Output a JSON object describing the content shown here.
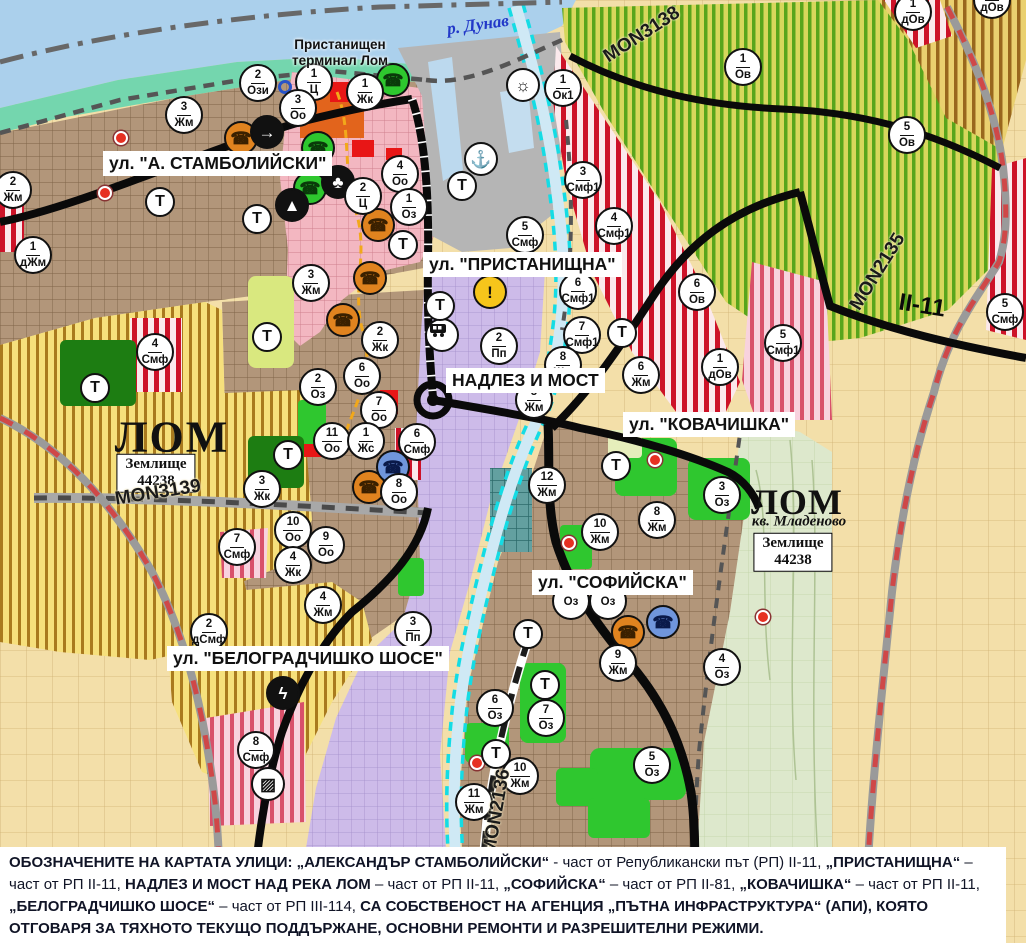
{
  "colors": {
    "water": "#abd0ec",
    "shore": "#74d6ae",
    "urban_brown": "#b2967a",
    "industrial_purple": "#cdbbe9",
    "vineyard_yellow": "#f6e07c",
    "orchard_green": "#d7d75c",
    "smf_pink": "#f3b7c1",
    "zone_red_stripe": "#cd1228",
    "road_black": "#0a0a0a",
    "railway_red": "#cf4848",
    "channel_cyan": "#14dce4",
    "park_green": "#2fc72f",
    "legend_text": "#101426"
  },
  "labels": [
    {
      "t": "ул. \"А. СТАМБОЛИЙСКИ\"",
      "name": "street-label-stamboliyski",
      "cls": "street",
      "x": 103,
      "y": 151
    },
    {
      "t": "ул. \"ПРИСТАНИЩНА\"",
      "name": "street-label-pristanishtna",
      "cls": "street",
      "x": 423,
      "y": 252
    },
    {
      "t": "НАДЛЕЗ И МОСТ",
      "name": "street-label-nadlez-i-most",
      "cls": "street",
      "x": 446,
      "y": 368
    },
    {
      "t": "ул. \"КОВАЧИШКА\"",
      "name": "street-label-kovachishka",
      "cls": "street",
      "x": 623,
      "y": 412
    },
    {
      "t": "ул. \"СОФИЙСКА\"",
      "name": "street-label-sofiyska",
      "cls": "street",
      "x": 532,
      "y": 570
    },
    {
      "t": "ул. \"БЕЛОГРАДЧИШКО ШОСЕ\"",
      "name": "street-label-belogradchishko-shose",
      "cls": "street",
      "x": 167,
      "y": 646
    },
    {
      "t": "р. Дунав",
      "name": "river-danube-label",
      "cls": "river",
      "x": 478,
      "y": 25,
      "c": 1,
      "rot": -8
    },
    {
      "t": "Пристанищен\nтерминал Лом",
      "name": "port-terminal-label",
      "cls": "place",
      "x": 340,
      "y": 53,
      "c": 1
    },
    {
      "t": "ЛОМ",
      "name": "city-label-lom",
      "cls": "city",
      "x": 172,
      "y": 437,
      "c": 1
    },
    {
      "t": "Землище\n44238",
      "name": "land-unit-44238-label",
      "cls": "zbox",
      "x": 156,
      "y": 473,
      "c": 1
    },
    {
      "t": "MON3139",
      "name": "road-label-mon3139",
      "cls": "road",
      "x": 158,
      "y": 493,
      "c": 1,
      "rot": -9
    },
    {
      "t": "ЛОМ",
      "name": "city-label-lom-mladenovo",
      "cls": "city2",
      "x": 797,
      "y": 502,
      "c": 1
    },
    {
      "t": "кв. Младеново",
      "name": "quarter-label-mladenovo",
      "cls": "quarter",
      "x": 799,
      "y": 522,
      "c": 1
    },
    {
      "t": "Землище\n44238",
      "name": "land-unit-44238-label-2",
      "cls": "zbox",
      "x": 793,
      "y": 552,
      "c": 1
    },
    {
      "t": "MON2135",
      "name": "road-label-mon2135",
      "cls": "road",
      "x": 878,
      "y": 272,
      "c": 1,
      "rot": -58
    },
    {
      "t": "MON3138",
      "name": "road-label-mon3138",
      "cls": "road",
      "x": 642,
      "y": 35,
      "c": 1,
      "rot": -33
    },
    {
      "t": "MON2136",
      "name": "road-label-mon2136",
      "cls": "road",
      "x": 497,
      "y": 812,
      "c": 1,
      "rot": -80
    },
    {
      "t": "II-11",
      "name": "road-label-ii-11",
      "cls": "roadbig",
      "x": 922,
      "y": 306,
      "c": 1,
      "rot": 9
    }
  ],
  "markers": [
    {
      "n": "2",
      "c": "Ози",
      "x": 258,
      "y": 83
    },
    {
      "n": "1",
      "c": "Ц",
      "x": 314,
      "y": 82
    },
    {
      "n": "1",
      "c": "Жк",
      "x": 365,
      "y": 92
    },
    {
      "n": "3",
      "c": "Оо",
      "x": 298,
      "y": 108
    },
    {
      "n": "3",
      "c": "Жм",
      "x": 184,
      "y": 115
    },
    {
      "n": "2",
      "c": "Жм",
      "x": 13,
      "y": 190
    },
    {
      "n": "1",
      "c": "дЖм",
      "x": 33,
      "y": 255
    },
    {
      "n": "1",
      "c": "Ок1",
      "x": 563,
      "y": 88
    },
    {
      "n": "4",
      "c": "Оо",
      "x": 400,
      "y": 174
    },
    {
      "n": "2",
      "c": "Ц",
      "x": 363,
      "y": 196
    },
    {
      "n": "1",
      "c": "Оз",
      "x": 409,
      "y": 207
    },
    {
      "n": "5",
      "c": "Смф",
      "x": 525,
      "y": 235
    },
    {
      "n": "3",
      "c": "Смф1",
      "x": 583,
      "y": 180
    },
    {
      "n": "4",
      "c": "Смф1",
      "x": 614,
      "y": 226
    },
    {
      "n": "6",
      "c": "Смф1",
      "x": 578,
      "y": 291
    },
    {
      "n": "7",
      "c": "Смф1",
      "x": 582,
      "y": 335
    },
    {
      "n": "6",
      "c": "Жм",
      "x": 641,
      "y": 375
    },
    {
      "n": "8",
      "c": "Жм",
      "x": 563,
      "y": 365
    },
    {
      "n": "5",
      "c": "Жм",
      "x": 534,
      "y": 400
    },
    {
      "n": "2",
      "c": "Пп",
      "x": 499,
      "y": 346
    },
    {
      "n": "2",
      "c": "Жк",
      "x": 380,
      "y": 340
    },
    {
      "n": "6",
      "c": "Оо",
      "x": 362,
      "y": 376
    },
    {
      "n": "2",
      "c": "Оз",
      "x": 318,
      "y": 387
    },
    {
      "n": "7",
      "c": "Оо",
      "x": 379,
      "y": 410
    },
    {
      "n": "11",
      "c": "Оо",
      "x": 332,
      "y": 441
    },
    {
      "n": "1",
      "c": "Жс",
      "x": 366,
      "y": 441
    },
    {
      "n": "6",
      "c": "Смф",
      "x": 417,
      "y": 442
    },
    {
      "n": "8",
      "c": "Оо",
      "x": 399,
      "y": 492
    },
    {
      "n": "3",
      "c": "Жк",
      "x": 262,
      "y": 489
    },
    {
      "n": "10",
      "c": "Оо",
      "x": 293,
      "y": 530
    },
    {
      "n": "9",
      "c": "Оо",
      "x": 326,
      "y": 545
    },
    {
      "n": "4",
      "c": "Жк",
      "x": 293,
      "y": 565
    },
    {
      "n": "7",
      "c": "Смф",
      "x": 237,
      "y": 547
    },
    {
      "n": "4",
      "c": "Смф",
      "x": 155,
      "y": 352
    },
    {
      "n": "3",
      "c": "Жм",
      "x": 311,
      "y": 283
    },
    {
      "n": "12",
      "c": "Жм",
      "x": 547,
      "y": 485
    },
    {
      "n": "10",
      "c": "Жм",
      "x": 600,
      "y": 532
    },
    {
      "n": "8",
      "c": "Жм",
      "x": 657,
      "y": 520
    },
    {
      "n": "3",
      "c": "Оз",
      "x": 722,
      "y": 495
    },
    {
      "n": "9",
      "c": "Жм",
      "x": 618,
      "y": 663
    },
    {
      "n": "4",
      "c": "Оз",
      "x": 722,
      "y": 667
    },
    {
      "n": "6",
      "c": "Оз",
      "x": 495,
      "y": 708
    },
    {
      "n": "7",
      "c": "Оз",
      "x": 546,
      "y": 718
    },
    {
      "n": "10",
      "c": "Жм",
      "x": 520,
      "y": 776
    },
    {
      "n": "11",
      "c": "Жм",
      "x": 474,
      "y": 802
    },
    {
      "n": "5",
      "c": "Оз",
      "x": 652,
      "y": 765
    },
    {
      "n": "2",
      "c": "дСмф",
      "x": 209,
      "y": 632
    },
    {
      "n": "4",
      "c": "Жм",
      "x": 323,
      "y": 605
    },
    {
      "n": "3",
      "c": "Пп",
      "x": 413,
      "y": 630
    },
    {
      "n": "8",
      "c": "Смф",
      "x": 256,
      "y": 750
    },
    {
      "n": "6",
      "c": "Ов",
      "x": 697,
      "y": 292
    },
    {
      "n": "1",
      "c": "дОв",
      "x": 720,
      "y": 367
    },
    {
      "n": "5",
      "c": "Смф1",
      "x": 783,
      "y": 343
    },
    {
      "n": "1",
      "c": "Ов",
      "x": 743,
      "y": 67
    },
    {
      "n": "5",
      "c": "Ов",
      "x": 907,
      "y": 135
    },
    {
      "n": "1",
      "c": "дОв",
      "x": 913,
      "y": 12
    },
    {
      "n": "5",
      "c": "Смф",
      "x": 1005,
      "y": 312
    },
    {
      "n": "1",
      "c": "дОв",
      "x": 992,
      "y": 0
    },
    {
      "n": "",
      "c": "Оз",
      "x": 571,
      "y": 601
    },
    {
      "n": "",
      "c": "Оз",
      "x": 608,
      "y": 601
    },
    {
      "n": "",
      "c": "Т",
      "x": 160,
      "y": 202
    },
    {
      "n": "",
      "c": "Т",
      "x": 257,
      "y": 219
    },
    {
      "n": "",
      "c": "Т",
      "x": 403,
      "y": 245
    },
    {
      "n": "",
      "c": "Т",
      "x": 462,
      "y": 186
    },
    {
      "n": "",
      "c": "Т",
      "x": 267,
      "y": 337
    },
    {
      "n": "",
      "c": "Т",
      "x": 288,
      "y": 455
    },
    {
      "n": "",
      "c": "Т",
      "x": 95,
      "y": 388
    },
    {
      "n": "",
      "c": "Т",
      "x": 622,
      "y": 333
    },
    {
      "n": "",
      "c": "Т",
      "x": 440,
      "y": 306
    },
    {
      "n": "",
      "c": "Т",
      "x": 616,
      "y": 466
    },
    {
      "n": "",
      "c": "Т",
      "x": 528,
      "y": 634
    },
    {
      "n": "",
      "c": "Т",
      "x": 545,
      "y": 685
    },
    {
      "n": "",
      "c": "Т",
      "x": 496,
      "y": 754
    }
  ],
  "icons": [
    {
      "name": "port-terminal-icon",
      "g": "☎",
      "x": 393,
      "y": 80,
      "bg": "#2ec72e",
      "fg": "#0a3a0a"
    },
    {
      "name": "culture-icon-green",
      "g": "☎",
      "x": 318,
      "y": 148,
      "bg": "#2ec72e",
      "fg": "#0a3a0a"
    },
    {
      "name": "culture-icon-green",
      "g": "☎",
      "x": 310,
      "y": 188,
      "bg": "#2ec72e",
      "fg": "#0a3a0a"
    },
    {
      "name": "culture-icon-orange",
      "g": "☎",
      "x": 241,
      "y": 138,
      "bg": "#e0831f",
      "fg": "#3a2000"
    },
    {
      "name": "culture-icon-orange",
      "g": "☎",
      "x": 378,
      "y": 225,
      "bg": "#e0831f",
      "fg": "#3a2000"
    },
    {
      "name": "culture-icon-orange",
      "g": "☎",
      "x": 370,
      "y": 278,
      "bg": "#e0831f",
      "fg": "#3a2000"
    },
    {
      "name": "culture-icon-orange",
      "g": "☎",
      "x": 343,
      "y": 320,
      "bg": "#e0831f",
      "fg": "#3a2000"
    },
    {
      "name": "culture-icon-orange",
      "g": "☎",
      "x": 369,
      "y": 487,
      "bg": "#e0831f",
      "fg": "#3a2000"
    },
    {
      "name": "culture-icon-orange",
      "g": "☎",
      "x": 628,
      "y": 632,
      "bg": "#e0831f",
      "fg": "#3a2000"
    },
    {
      "name": "culture-icon-blue",
      "g": "☎",
      "x": 393,
      "y": 467,
      "bg": "#7096dc",
      "fg": "#0a1a4a"
    },
    {
      "name": "culture-icon-blue",
      "g": "☎",
      "x": 663,
      "y": 622,
      "bg": "#7096dc",
      "fg": "#0a1a4a"
    },
    {
      "name": "sun-icon",
      "g": "☼",
      "x": 523,
      "y": 85,
      "bg": "#ffffff",
      "fg": "#111111"
    },
    {
      "name": "anchor-icon",
      "g": "⚓",
      "x": 481,
      "y": 159,
      "bg": "#ffffff",
      "fg": "#111111"
    },
    {
      "name": "arrow-icon",
      "g": "→",
      "x": 267,
      "y": 132,
      "bg": "#111111",
      "fg": "#ffffff"
    },
    {
      "name": "clover-icon",
      "g": "♣",
      "x": 338,
      "y": 182,
      "bg": "#111111",
      "fg": "#ffffff"
    },
    {
      "name": "mound-icon",
      "g": "▲",
      "x": 292,
      "y": 205,
      "bg": "#111111",
      "fg": "#ffffff"
    },
    {
      "name": "lightning-icon",
      "g": "ϟ",
      "x": 283,
      "y": 693,
      "bg": "#111111",
      "fg": "#ffffff"
    },
    {
      "name": "railway-crossing-icon",
      "g": "▨",
      "x": 268,
      "y": 784,
      "bg": "#ffffff",
      "fg": "#111111"
    },
    {
      "name": "bus-station-icon",
      "g": "bus",
      "x": 442,
      "y": 335,
      "bg": "#ffffff",
      "fg": "#111111"
    },
    {
      "name": "warning-icon",
      "g": "!",
      "x": 490,
      "y": 292,
      "bg": "#f6c51b",
      "fg": "#111111"
    }
  ],
  "dots": [
    {
      "type": "red",
      "x": 121,
      "y": 138
    },
    {
      "type": "red",
      "x": 105,
      "y": 193
    },
    {
      "type": "red",
      "x": 655,
      "y": 460
    },
    {
      "type": "red",
      "x": 569,
      "y": 543
    },
    {
      "type": "red",
      "x": 477,
      "y": 763
    },
    {
      "type": "red",
      "x": 763,
      "y": 617
    },
    {
      "type": "blue",
      "x": 285,
      "y": 87
    }
  ],
  "legend": {
    "segments": [
      {
        "t": "ОБОЗНАЧЕНИТЕ НА КАРТАТА УЛИЦИ: „АЛЕКСАНДЪР СТАМБОЛИЙСКИ“",
        "b": true
      },
      {
        "t": " - част от Републикански път (РП) II-11, ",
        "b": false
      },
      {
        "t": "„ПРИСТАНИЩНА“",
        "b": true
      },
      {
        "t": " – част от РП II-11, ",
        "b": false
      },
      {
        "t": "НАДЛЕЗ И МОСТ НАД РЕКА ЛОМ",
        "b": true
      },
      {
        "t": " – част от РП II-11, ",
        "b": false
      },
      {
        "t": "„СОФИЙСКА“",
        "b": true
      },
      {
        "t": " – част от РП II-81, ",
        "b": false
      },
      {
        "t": "„КОВАЧИШКА“",
        "b": true
      },
      {
        "t": " – част от РП II-11, ",
        "b": false
      },
      {
        "t": "„БЕЛОГРАДЧИШКО ШОСЕ“",
        "b": true
      },
      {
        "t": " – част от РП III-114, ",
        "b": false
      },
      {
        "t": "СА СОБСТВЕНОСТ НА АГЕНЦИЯ „ПЪТНА ИНФРАСТРУКТУРА“ (АПИ), КОЯТО ОТГОВАРЯ ЗА ТЯХНОТО ТЕКУЩО ПОДДЪРЖАНЕ, ОСНОВНИ РЕМОНТИ И РАЗРЕШИТЕЛНИ РЕЖИМИ.",
        "b": true
      }
    ]
  }
}
